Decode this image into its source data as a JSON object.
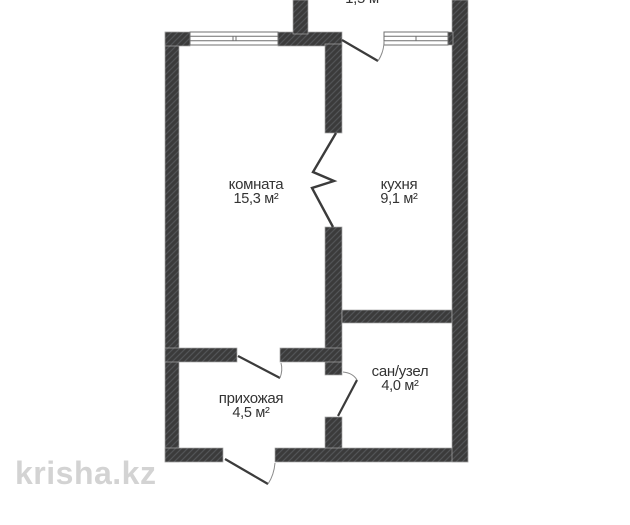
{
  "plan": {
    "balcony": {
      "label": "1,5 м"
    },
    "rooms": [
      {
        "name": "комната",
        "area": "15,3 м²"
      },
      {
        "name": "кухня",
        "area": "9,1 м²"
      },
      {
        "name": "прихожая",
        "area": "4,5 м²"
      },
      {
        "name": "сан/узел",
        "area": "4,0 м²"
      }
    ]
  },
  "watermark": {
    "text": "krisha.kz"
  },
  "colors": {
    "background": "#ffffff",
    "wall": "#3b3b3b",
    "hatch_line": "#525457",
    "wall_edge": "#a8a8a8",
    "window_line": "#6f6f6f",
    "door_line": "#3b3b3b",
    "arc_line": "#8a8a8a",
    "label_text": "#333333",
    "watermark_text": "#d3d3d3"
  }
}
